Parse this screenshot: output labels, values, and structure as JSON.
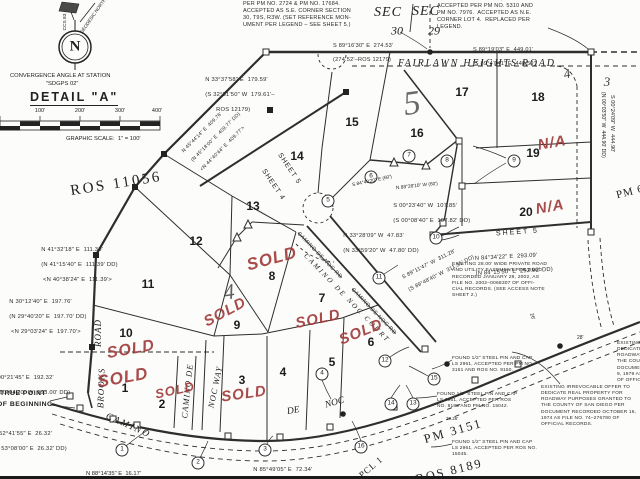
{
  "north_detail": {
    "letter": "N",
    "ccs_label": "CCS 83",
    "geodesic_label": "GEODESIC NORTH",
    "convergence_line1": "CONVERGENCE ANGLE AT STATION",
    "convergence_line2": "\"SDGPS 02\"",
    "detail_title": "DETAIL \"A\""
  },
  "scale_bar": {
    "ticks": [
      "100'",
      "200'",
      "300'",
      "400'"
    ],
    "caption": "GRAPHIC SCALE:  1\" = 100'"
  },
  "section_corner": {
    "sec_left": "SEC",
    "sec_right": "SEC",
    "num_left": "30",
    "num_right": "29"
  },
  "references": {
    "ros_11056": "ROS 11056",
    "pm_3151": "PM 3151",
    "ros_8189": "ROS 8189",
    "pm_6": "PM 6",
    "pcl_1": "PCL 1"
  },
  "roads": {
    "fairlawn": "FAIRLAWN HEIGHTS ROAD",
    "brooks_word_road": "ROAD",
    "brooks_word_brooks": "BROOKS",
    "camino_curve": "CAMINO",
    "de_token": "DE",
    "noc_token": "NOC",
    "camino_de_vertical": "CAMINO DE",
    "noc_way": "NOC WAY",
    "court": "CAMINO DE NOC COURT",
    "court_struck": "CAMINO DE NOC RD"
  },
  "lots": [
    "1",
    "2",
    "3",
    "4",
    "5",
    "6",
    "7",
    "8",
    "9",
    "10",
    "11",
    "12",
    "13",
    "14",
    "15",
    "16",
    "17",
    "18",
    "19",
    "20"
  ],
  "adjacent_lots": {
    "lot_3": "3",
    "lot_4": "4"
  },
  "script_numerals": {
    "sheet_5": "5",
    "sheet_4": "4"
  },
  "sheet_labels": {
    "sheet_4": "SHEET 4",
    "sheet_5": "SHEET 5"
  },
  "annotations": {
    "sold": "SOLD",
    "na": "N/A"
  },
  "markers": [
    "1",
    "2",
    "3",
    "4",
    "5",
    "6",
    "7",
    "8",
    "9",
    "10",
    "11",
    "12",
    "13",
    "14",
    "15",
    "16"
  ],
  "bearings": {
    "fairlawn_west": {
      "l1": "S 89°16'30\" E  274.53'",
      "l2": "(274.52'–ROS 12179)"
    },
    "fairlawn_east": {
      "l1": "S 89°19'03\" E  449.01'",
      "l2": "[S 89°47'41\" E  448.59']"
    },
    "northeast_diag": {
      "l1": "N 33°37'58\" E  179.59'",
      "l2": "(S 32°31'50\" W  179.61'–",
      "l3": "      ROS 12179)"
    },
    "west_long": {
      "l1": "N 45°44'14\" E  409.76'",
      "l2": "(N 45°18'00\" E  409.77' DD)",
      "l3": "<N 44°40'44\" E  409.77'>"
    },
    "west_111": {
      "l1": "N 41°32'18\" E  111.30'",
      "l2": "(N 41°15'40\" E  111.39' DD)",
      "l3": " <N 40°38'24\" E  111.39'>"
    },
    "west_197": {
      "l1": "N 30°12'40\" E  197.76'",
      "l2": "(N 29°40'20\" E  197.70' DD)",
      "l3": " <N 29°03'24\" E  197.70'>"
    },
    "west_192": {
      "l1": "N 00°21'45\" E  192.32'",
      "l2": "(N 00°04'20\" W  193.00' DD)"
    },
    "southwest_26": {
      "l1": "S 52°41'55\" E  26.32'",
      "l2": "(S 53°08'00\" E  26.32' DD)"
    },
    "bottom_72": {
      "l1": "N 85°49'05\" E  72.34'",
      "l2": "(N 86°13'08\" E  72.34' DD)"
    },
    "bottom_16": {
      "l1": "N 88°14'35\" E  16.17'"
    },
    "court_47": {
      "l1": "N 33°28'09\" W  47.83'",
      "l2": "(N 33°59'20\" W  47.80' DD)"
    },
    "mid_107": {
      "l1": "S 00°23'40\" W  107.85'",
      "l2": "(S 00°08'40\" E  107.82' DD)"
    },
    "diag_311": {
      "l1": "S 89°11'47\" W  311.28'",
      "l2": "(S 89°48'40\" W  311.31' DD)"
    },
    "sheet5_293": {
      "l1": "N 84°34'22\" E  293.09'",
      "l2": "(N 84°15'50\" E  292.92' DD)"
    },
    "east_444": {
      "l1": "S 00°24'09\" W  444.90'",
      "l2": "(N 00°03'50\" W  444.90' DD)"
    },
    "tiny_60_a": {
      "l1": "S 84°40'20\" E (60')"
    },
    "tiny_60_b": {
      "l1": "N 88°28'10\" W (60')"
    }
  },
  "notes": {
    "se_corner": "PER PM NO. 2724 & PM NO. 17684.\nACCEPTED AS S.E. CORNER SECTION\n30, T9S, R3W. (SET REFERENCE MON-\nUMENT PER LEGEND – SEE SHEET 5.)",
    "ne_corner": "FOUND 1/2\" STEEL PIN, NO CAP.\nACCEPTED PER PM NO. 5310 AND\nPM NO. 7976.  ACCEPTED AS N.E.\nCORNER LOT 4.  REPLACED PER\nLEGEND.",
    "easement": "EXISTING 28.00' WIDE PRIVATE ROAD\nAND UTILITY EASEMENT PER DEED\nRECORDED JANUARY 28, 2002, AS\nFILE NO. 2002–0068307 OF OFFI-\nCIAL RECORDS. (SEE ACCESS NOTE\nSHEET 2.)",
    "irrevocable_1974": "EXISTING IRREVOCABLE OFFER TO\nDEDICATE REAL PROPERTY FOR\nROADWAY PURPOSES GRANTED TO\nTHE COUNTY OF SAN DIEGO PER\nDOCUMENT RECORDED OCTOBER 16,\n1974 AS FILE NO. 74–276780 OF\nOFFICIAL RECORDS.",
    "irrevocable_1979": "EXISTING IRREVOCABLE\nDEDICATE REAL PROPE\nROADWAY PURPOSES\nTHE COUNTY OF SAN\nDOCUMENT RECORDED\n9, 1979 AS FILE NO\nOF OFFICIAL RECORD",
    "found_pin_1": "FOUND 1/2\" STEEL PIN AND CAP\nLS 2961, ACCEPTED PER PM NO.\n3151 AND ROS NO. 9150.",
    "found_pin_2": "FOUND 1/2\" STEEL PIN AND CAP\nLS 2961, ACCEPTED PER ROS\nNO. 8189 AND PM NO. 15042.",
    "found_pin_3": "FOUND 1/2\" STEEL PIN AND CAP\nLS 2961, ACCEPTED PER ROS NO.\n15045."
  },
  "misc": {
    "true_point_line1": "TRUE POINT",
    "true_point_line2": "OF BEGINNING",
    "dim_30_26": "30.26'",
    "dim_28": "28'",
    "dim_26": "26'"
  }
}
